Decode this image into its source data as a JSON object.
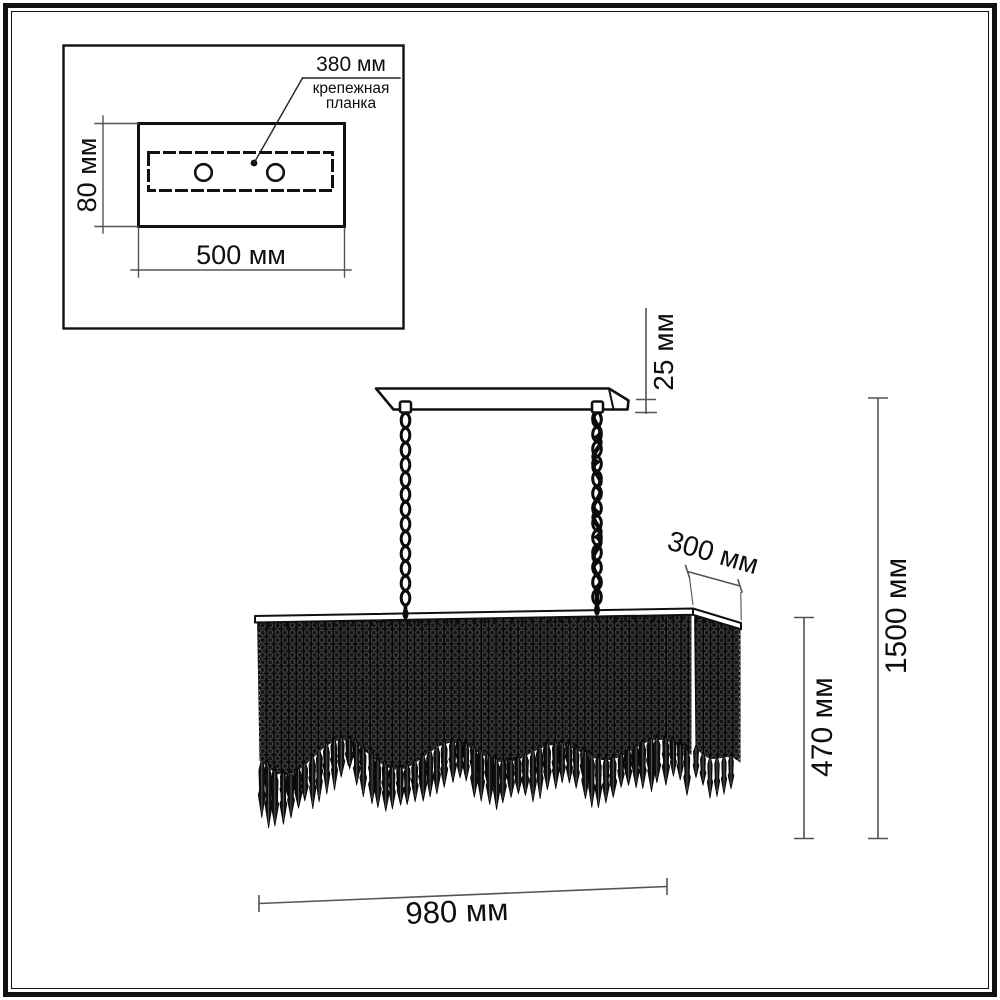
{
  "colors": {
    "ink": "#111111",
    "dim_line": "#555555",
    "crystal_fill": "#131313"
  },
  "inset_diagram": {
    "bracket_length_label": "380 мм",
    "bracket_name_label": "крепежная планка",
    "plate_depth_label": "80 мм",
    "plate_width_label": "500 мм"
  },
  "main_diagram": {
    "canopy_thickness_label": "25 мм",
    "shade_depth_label": "300 мм",
    "shade_height_label": "470 мм",
    "overall_height_label": "1500 мм",
    "shade_width_label": "980 мм"
  }
}
